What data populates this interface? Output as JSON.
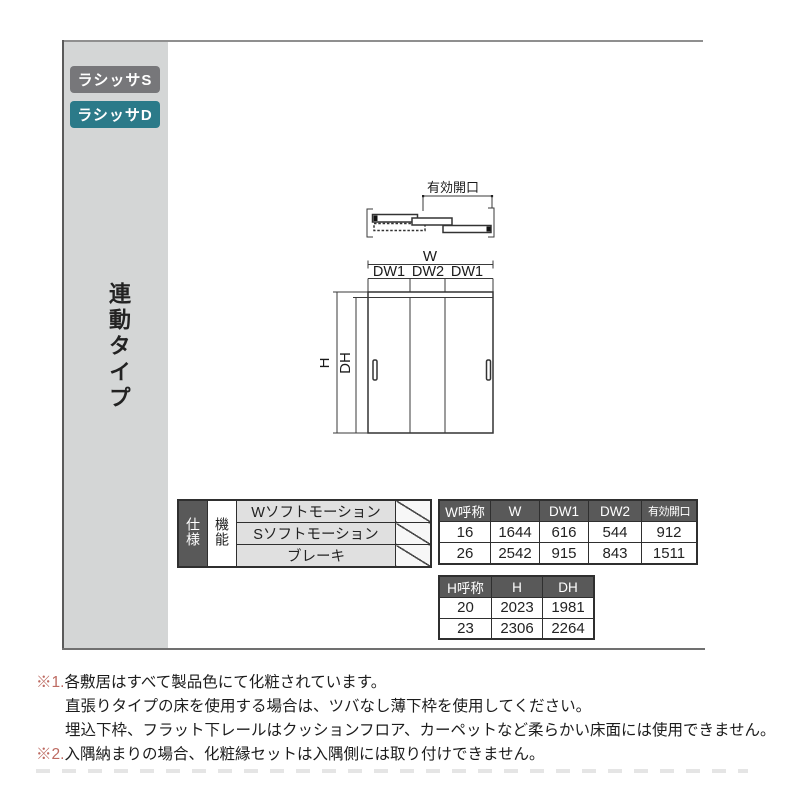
{
  "sidebar": {
    "tabs": [
      {
        "label": "ラシッサS",
        "color": "#77777a"
      },
      {
        "label": "ラシッサD",
        "color": "#2b7a89"
      }
    ],
    "type_label": "連動タイプ"
  },
  "diagram": {
    "plan": {
      "opening_label": "有効開口"
    },
    "elevation": {
      "w_label": "W",
      "dw_labels": [
        "DW1",
        "DW2",
        "DW1"
      ],
      "h_label": "H",
      "dh_label": "DH"
    }
  },
  "spec_table": {
    "row_header": "仕様",
    "col_header": "機能",
    "functions": [
      "Wソフトモーション",
      "Sソフトモーション",
      "ブレーキ"
    ]
  },
  "w_table": {
    "headers": [
      "W呼称",
      "W",
      "DW1",
      "DW2",
      "有効開口"
    ],
    "rows": [
      [
        "16",
        "1644",
        "616",
        "544",
        "912"
      ],
      [
        "26",
        "2542",
        "915",
        "843",
        "1511"
      ]
    ]
  },
  "h_table": {
    "headers": [
      "H呼称",
      "H",
      "DH"
    ],
    "rows": [
      [
        "20",
        "2023",
        "1981"
      ],
      [
        "23",
        "2306",
        "2264"
      ]
    ]
  },
  "notes": [
    {
      "marker": "※1.",
      "lines": [
        "各敷居はすべて製品色にて化粧されています。",
        "直張りタイプの床を使用する場合は、ツバなし薄下枠を使用してください。",
        "埋込下枠、フラット下レールはクッションフロア、カーペットなど柔らかい床面には使用できません。"
      ]
    },
    {
      "marker": "※2.",
      "lines": [
        "入隅納まりの場合、化粧縁セットは入隅側には取り付けできません。"
      ]
    }
  ],
  "colors": {
    "tab_s_bg": "#77777a",
    "tab_d_bg": "#2b7a89",
    "sidebar_bg": "#d4d6d6",
    "table_header_bg": "#595959",
    "function_cell_bg": "#e0e0e0",
    "note_marker": "#bd6a61"
  }
}
